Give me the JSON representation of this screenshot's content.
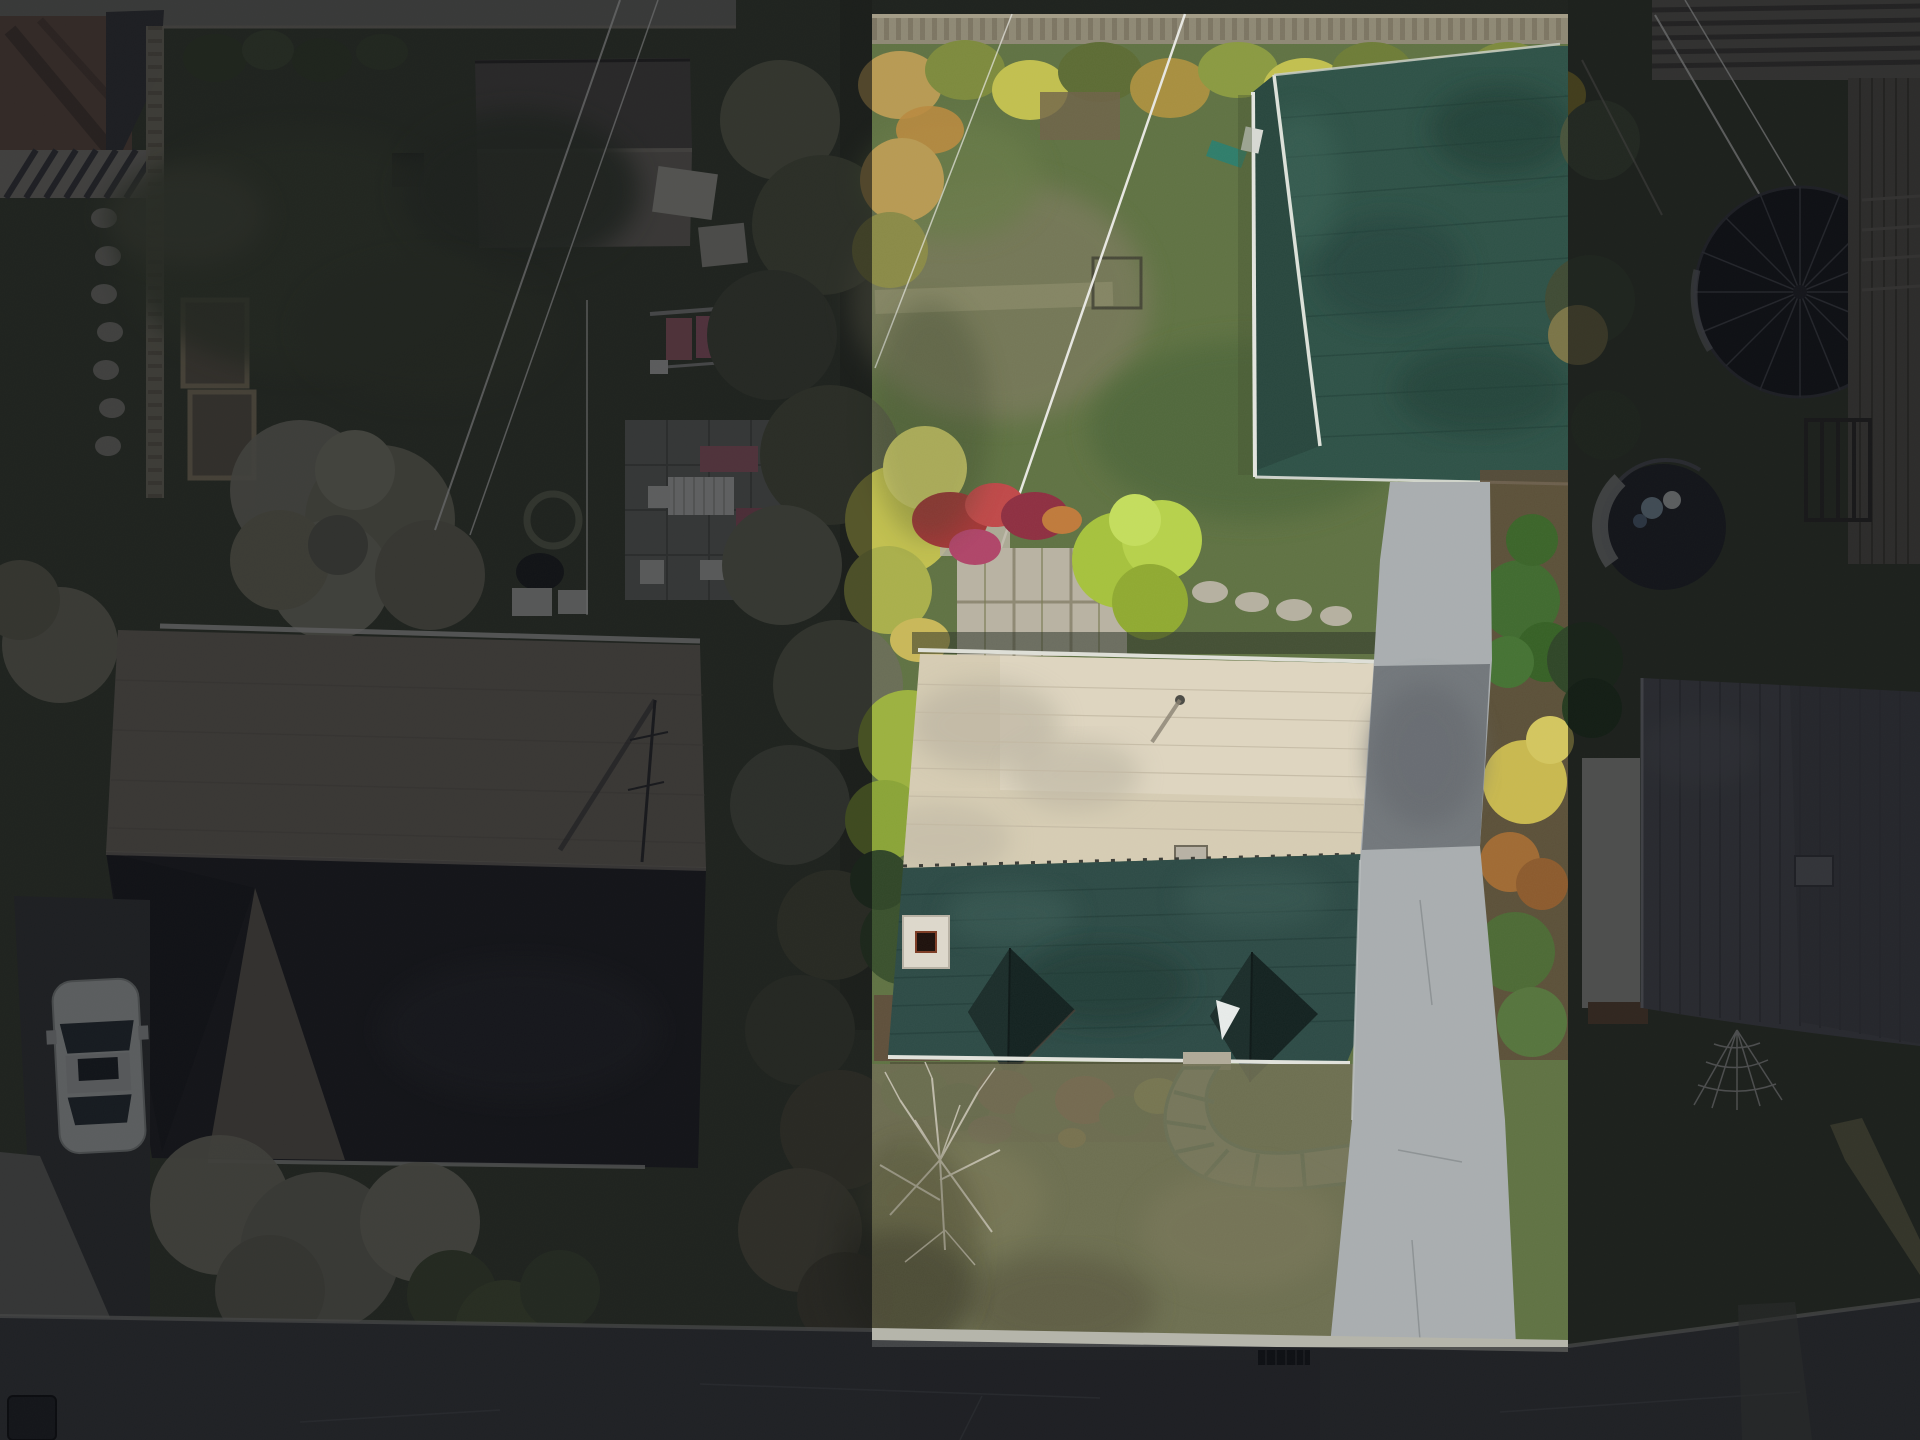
{
  "meta": {
    "kind": "aerial-drone-photograph",
    "description": "Top-down drone photo of a residential lot selection: center-right parcel is highlighted at full exposure, surrounding properties are dimmed",
    "width_px": 1920,
    "height_px": 1440
  },
  "highlight": {
    "x": 872,
    "y": 14,
    "width": 696,
    "height": 1333,
    "dim_color": "#090b10",
    "dim_opacity": 0.58
  },
  "colors": {
    "lawn_bright": "#5f7242",
    "lawn_dry": "#6f6f52",
    "lawn_dim": "#3f4634",
    "lawn_dim_right": "#39402f",
    "roof_tan_bright": "#d7cdb4",
    "roof_tan_dim": "#7e776a",
    "roof_teal": "#2c4a45",
    "roof_dark_dim": "#232326",
    "garage_green": "#2d5146",
    "ridge_white": "#dde2da",
    "concrete": "#a9aeb0",
    "asphalt_patch": "#72777b",
    "road": "#404244",
    "curb": "#b5b5aa",
    "paver": "#b9b3a2",
    "walkway_stone": "#b9b4a4",
    "walkway_edge": "#3f7668",
    "shrub_red": "#a33636",
    "shrub_magenta": "#b04468",
    "shrub_yellow": "#c2c04e",
    "shrub_chartreuse": "#a6c23c",
    "shrub_orange": "#b98a3e",
    "conifer": "#3f6a2e",
    "mulch": "#5a4a36",
    "fence_wood": "#8e8874",
    "alley": "#7b7b72",
    "brick": "#6e5647",
    "pale_tree": "#8a8876",
    "car_body": "#cfd2cf",
    "glass": "#2a3338",
    "trampoline": "#17181c",
    "deck_wood": "#5f5b52",
    "neighbor_roof": "#56575c",
    "wall_white": "#b9b7ae",
    "pool_cover": "#23252a",
    "pool_rim": "#9a9c98",
    "power_line": "#e8e8e2",
    "chimney": "#ded9cc",
    "dormer": "#12211f",
    "skylight": "#e8ecea",
    "downspout": "#2e7d6a",
    "drain": "#16181a"
  },
  "objects": {
    "selected_parcel": "center-right residential lot (house with tan/teal roof, detached green-roof garage, driveway, backyard lawn)",
    "left_property": "dimmed lot with large tan/black hip-roof house, white car on driveway, patio furniture, shed, garden beds",
    "right_property": "dimmed lot with gray-roof house, wood deck, covered trampoline, covered round pool, spider-web lawn decoration",
    "road": "street along bottom edge with curb and storm drain"
  }
}
